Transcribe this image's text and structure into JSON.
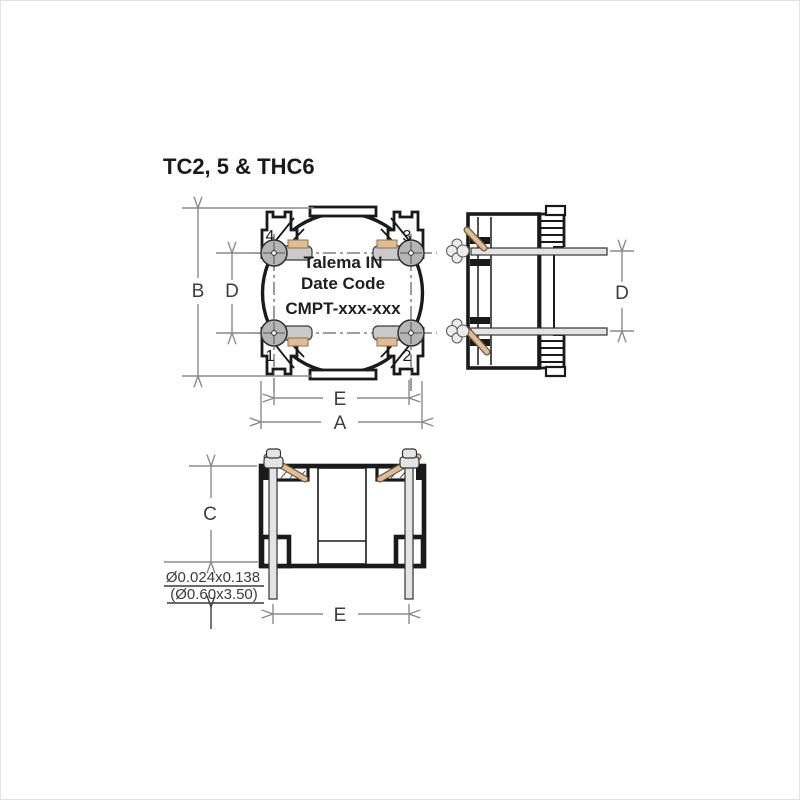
{
  "title": "TC2, 5 & THC6",
  "colors": {
    "outline": "#1a1a1a",
    "dimension": "#8a8a8a",
    "dimension_text": "#3c3c3c",
    "marking_text": "#1f1f1f",
    "pad_fill": "#b5b5b5",
    "pin_fill": "#e4e4e4",
    "wire_fill": "#e2bd94"
  },
  "top_view": {
    "marking": {
      "line1": "Talema IN",
      "line2": "Date Code",
      "line3": "CMPT-xxx-xxx"
    },
    "pin_numbers": {
      "p1": "1",
      "p2": "2",
      "p3": "3",
      "p4": "4"
    },
    "dims": {
      "overall_height": "B",
      "vertical_pin_pitch": "D",
      "horizontal_pin_pitch": "E",
      "overall_width": "A"
    }
  },
  "side_view": {
    "dims": {
      "vertical_pin_pitch": "D"
    }
  },
  "front_view": {
    "dims": {
      "body_height": "C",
      "horizontal_pin_pitch": "E"
    },
    "pin_note": {
      "imperial": "Ø0.024x0.138",
      "metric": "(Ø0.60x3.50)"
    }
  }
}
